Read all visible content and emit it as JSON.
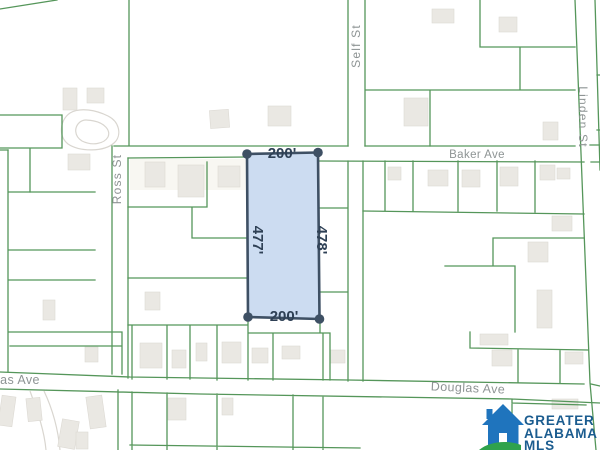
{
  "streets": {
    "baker": "Baker Ave",
    "douglas": "Douglas Ave",
    "douglas_partial_left": "las Ave",
    "ross": "Ross St",
    "self": "Self St",
    "linden": "Linden St"
  },
  "parcel": {
    "dim_top": "200'",
    "dim_bottom": "200'",
    "dim_left": "477'",
    "dim_right": "478'",
    "fill_color": "#c7d8ef",
    "outline_color": "#3e5064",
    "label_color": "#2e4055"
  },
  "map_colors": {
    "parcel_lines": "#55965a",
    "street_labels": "#8e9494",
    "buildings": "#eae8e3",
    "driveways": "#d9d6d0"
  },
  "logo": {
    "name_line1": "GREATER",
    "name_line2": "ALABAMA",
    "name_line3": "MLS",
    "house_color": "#1f74bd",
    "swoosh_color": "#2fa24c",
    "text_color": "#1b5c8f"
  }
}
